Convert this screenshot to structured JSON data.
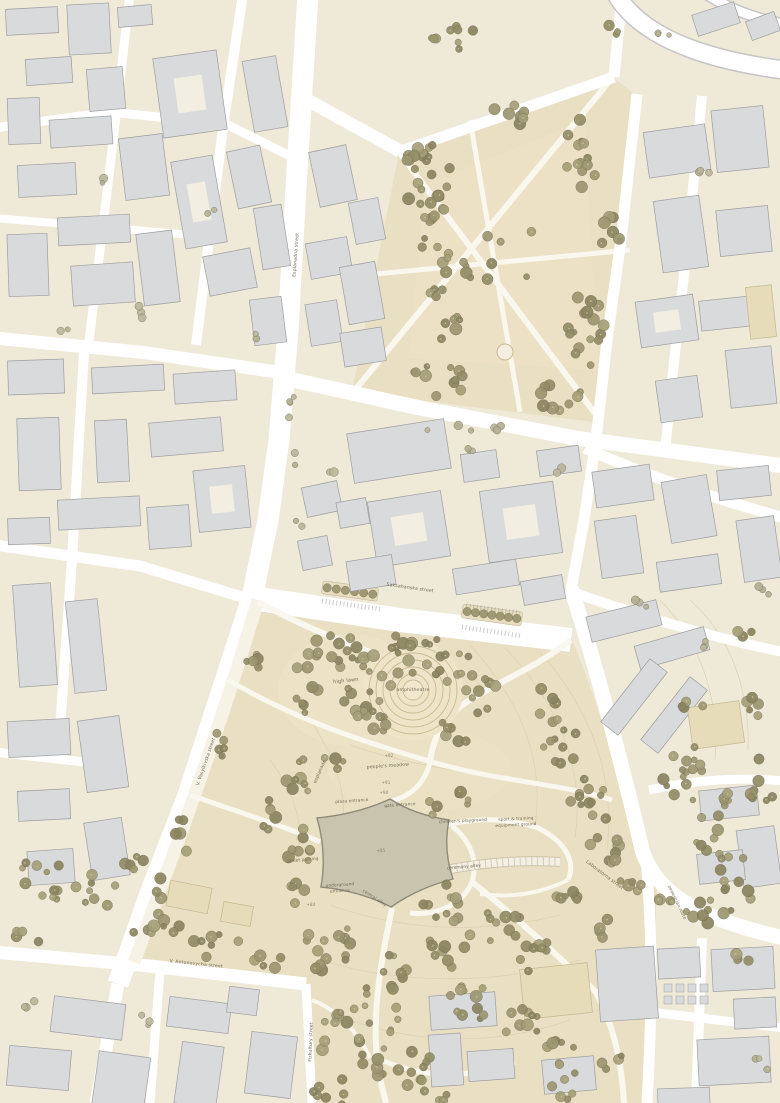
{
  "map": {
    "street_labels": {
      "saksahansky": "Saksahanska street",
      "esplanadna": "Esplanadna street",
      "vasylkivska": "V. Vasylkivska street",
      "antonovycha": "V. Antonovycha street",
      "fizkultury": "Fizkultury street",
      "laboratorna": "Laboratorna street",
      "pedestrian_route": "pedestrian route"
    },
    "park_labels": {
      "high_lawn": "high lawn",
      "amphitheatre": "amphitheatre",
      "esplanade": "esplanade",
      "peoples_meadow": "people's meadow",
      "plaza_entrance": "plaza entrance",
      "gate_entrance": "gate entrance",
      "childrens_playground": "children's playground",
      "sport_ground_line1": "sport & training",
      "sport_ground_line2": "equipment ground",
      "ceremony_alley": "ceremony alley",
      "underground_line1": "underground",
      "underground_line2": "entrance",
      "street_parking": "street parking",
      "central_alley": "central alley"
    },
    "elevations": {
      "e92": "+92",
      "e91": "+91",
      "e90": "+90",
      "e85": "+85",
      "e84": "+84"
    },
    "colors": {
      "block": "#efe9d8",
      "park": "#e9dfc2",
      "lawn": "#ece2c6",
      "road": "#ffffff",
      "road_edge": "#c6c6c6",
      "path": "#faf7ef",
      "esplanade": "#f6f2e6",
      "building": "#d9dadb",
      "building_stroke": "#9d9e9f",
      "tan_building": "#e6dcba",
      "tan_stroke": "#c5b88e",
      "courtyard": "#f2eee2",
      "plaza": "#c8c4ad",
      "plaza_stroke": "#8f8b7a",
      "contour": "#dcd1b0",
      "ring": "#c9ba92",
      "median": "#e8debe",
      "tree_dark": "#8a8460",
      "tree_mid": "#9c9670",
      "tree_light": "#a59f78",
      "sage": "#b2ae92",
      "label": "#6f6853"
    }
  }
}
